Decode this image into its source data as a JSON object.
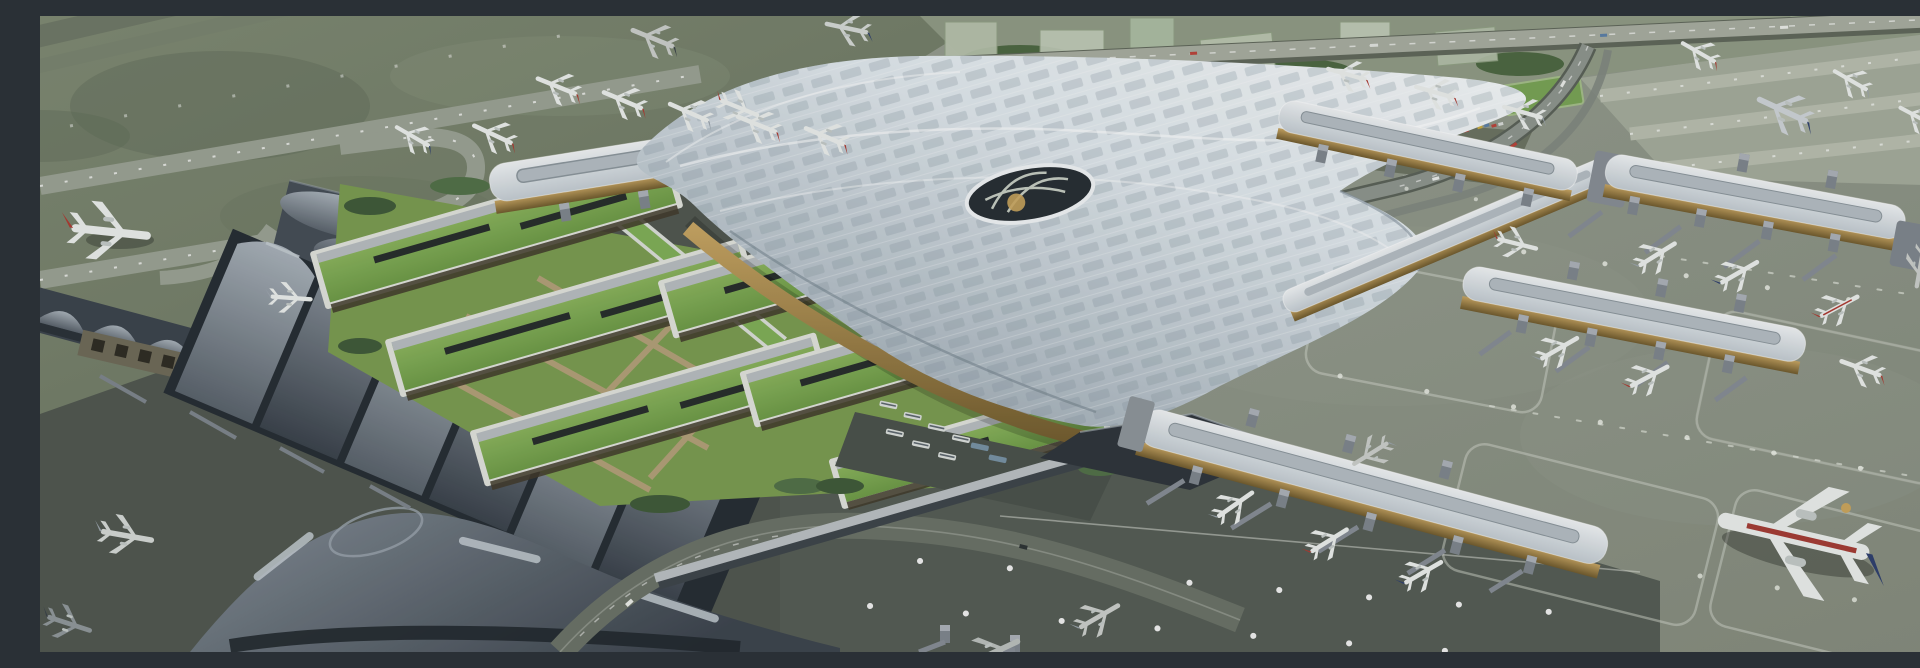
{
  "scene": {
    "description": "Aerial 3D architectural rendering of a large airport complex: a flowing silver wave-roof main terminal with perforated panel pattern and a central oculus, rows of green-roofed ground-transport buildings with lawns, an older wave-roofed terminal with a dark Y-shaped satellite at lower left, a straight gate concourse at top with red-tailed airliners, three eastern gate piers with jet bridges and parked aircraft including a blue-tailed 747, grass airfield with looping taxiways at upper left, and a city strip with highway, elevated access road and a full car park at upper right.",
    "style": "photorealistic CGI render, oblique aerial view, overcast daylight",
    "palette": {
      "grass_field": "#74806a",
      "taxiway": "#9aa193",
      "apron": "#8b9284",
      "apron_light": "#a3aa9b",
      "apron_shadow": "#4f564f",
      "roof_light": "#f2f6f7",
      "roof_mid": "#ccd6dc",
      "roof_shadow": "#9aa6b0",
      "wave_roof_light": "#a8b1b9",
      "wave_roof_dark": "#414a53",
      "glass_dark": "#262d33",
      "gold_facade": "#b0914f",
      "green_roof": "#82ae55",
      "lawn": "#7a9b50",
      "path_tan": "#b7a07c",
      "tree": "#4c6741",
      "tail_red": "#ac3a31",
      "tail_blue": "#2e3f6e",
      "marking_white": "#e9ece4",
      "road": "#6a7166"
    },
    "labels": {
      "main_terminal": "Main terminal wave roof with oculus",
      "north_concourse": "North gate concourse",
      "east_piers": "Eastern gate piers with jet bridges",
      "gtc": "Green-roofed ground transportation center",
      "old_terminal": "Existing wave-roof terminal and Y satellite",
      "airfield": "Grass airfield with taxiway loops",
      "city": "City blocks, highway and car park",
      "aircraft": "Parked and taxiing airliners",
      "jumbo": "Blue-tailed 747 at stand"
    }
  }
}
